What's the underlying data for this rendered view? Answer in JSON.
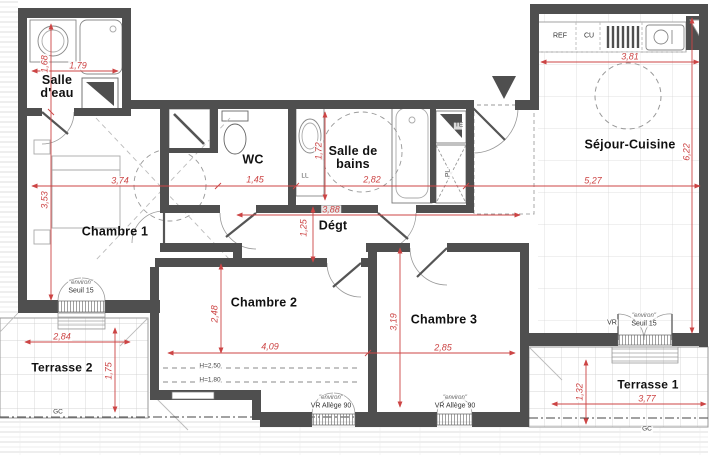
{
  "plan": {
    "type": "apartment-floor-plan",
    "rooms": {
      "salle_deau": "Salle d'eau",
      "wc": "WC",
      "salle_de_bains": "Salle de bains",
      "sejour_cuisine": "Séjour-Cuisine",
      "chambre1": "Chambre 1",
      "chambre2": "Chambre 2",
      "chambre3": "Chambre 3",
      "degt": "Dégt",
      "terrasse1": "Terrasse 1",
      "terrasse2": "Terrasse 2"
    },
    "dimensions": {
      "salle_deau_width": "1,79",
      "salle_deau_height": "1,68",
      "chambre1_width": "3,74",
      "chambre1_height": "3,53",
      "wc_width": "1,45",
      "sdb_width": "2,82",
      "sdb_height": "1,72",
      "cuisine_width": "3,81",
      "sejour_width": "5,27",
      "sejour_height": "6,22",
      "degt_width": "3,88",
      "degt_height": "1,25",
      "chambre2_width": "4,09",
      "chambre2_height": "2,48",
      "chambre3_width": "2,85",
      "chambre3_height": "3,19",
      "terrasse2_width": "2,84",
      "terrasse2_height": "1,75",
      "terrasse1_width": "3,77",
      "terrasse1_height": "1,32"
    },
    "annotations": {
      "ref": "REF",
      "cu": "CU",
      "ll": "LL",
      "te": "TE",
      "pl": "PL",
      "gc": "GC",
      "h_250": "H=2.50",
      "h_180": "H=1.80",
      "environ": "\"environ\"",
      "seuil_15": "Seuil 15",
      "vr": "VR",
      "vr_allege_90": "VR Allège 90"
    },
    "colors": {
      "wall": "#4f4f4f",
      "dimension": "#cc4444",
      "label": "#111111",
      "grid": "#c9c9c9"
    }
  }
}
